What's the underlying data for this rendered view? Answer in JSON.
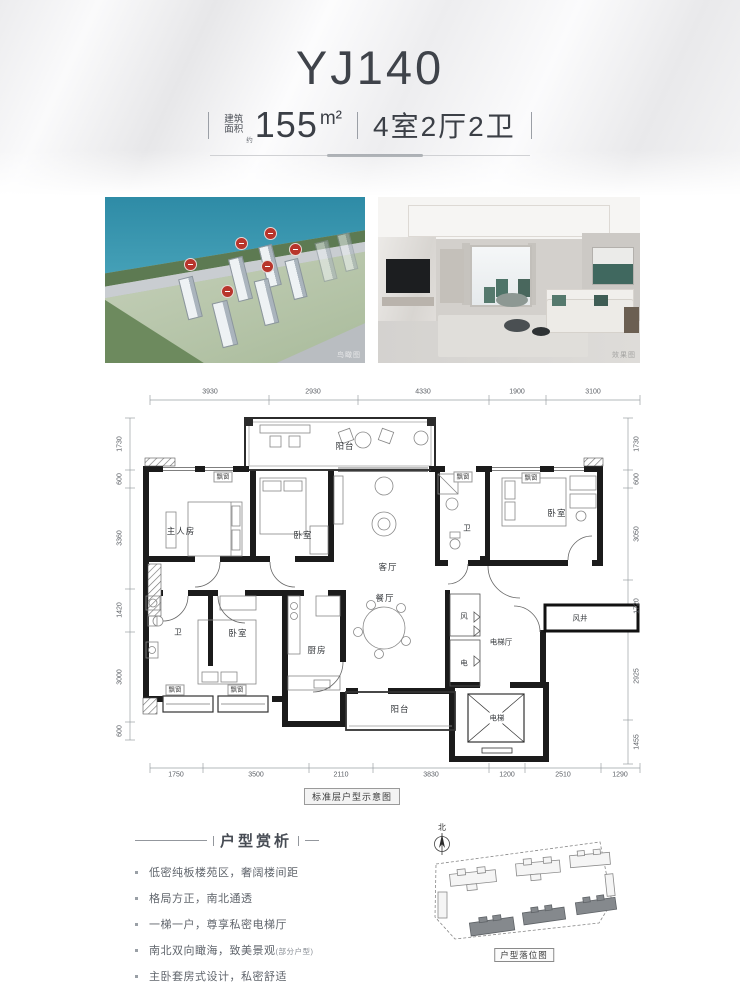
{
  "header": {
    "title": "YJ140",
    "area_label_line1": "建筑",
    "area_label_line2": "面积",
    "area_approx": "约",
    "area_value": "155",
    "area_unit": "m²",
    "rooms_spec": "4室2厅2卫"
  },
  "photos": {
    "aerial_caption": "鸟瞰图",
    "interior_caption": "效果图"
  },
  "floorplan": {
    "caption": "标准层户型示意图",
    "dims_top": [
      "3930",
      "2930",
      "4330",
      "1900",
      "3100"
    ],
    "dims_bottom": [
      "1750",
      "3500",
      "2110",
      "3830",
      "1200",
      "2510",
      "1290"
    ],
    "dims_left": [
      "1730",
      "600",
      "3360",
      "1420",
      "3000",
      "600"
    ],
    "dims_right": [
      "1730",
      "600",
      "3050",
      "1720",
      "2925",
      "1455"
    ],
    "rooms": {
      "master_bedroom": "主人房",
      "bedroom": "卧室",
      "living_room": "客厅",
      "dining_room": "餐厅",
      "bathroom": "卫",
      "kitchen": "厨房",
      "balcony": "阳台",
      "bay_window": "飘窗",
      "wind": "风",
      "electric": "电",
      "elevator_hall": "电梯厅",
      "elevator": "电梯",
      "wind_shaft": "风井"
    }
  },
  "analysis": {
    "title": "户型赏析",
    "bullets": [
      "低密纯板楼苑区，奢阔楼间距",
      "格局方正，南北通透",
      "一梯一户，尊享私密电梯厅",
      "南北双向瞰海，致美景观",
      "主卧套房式设计，私密舒适"
    ],
    "bullet_note": "(部分户型)"
  },
  "siteplan": {
    "caption": "户型落位图",
    "north": "北"
  }
}
